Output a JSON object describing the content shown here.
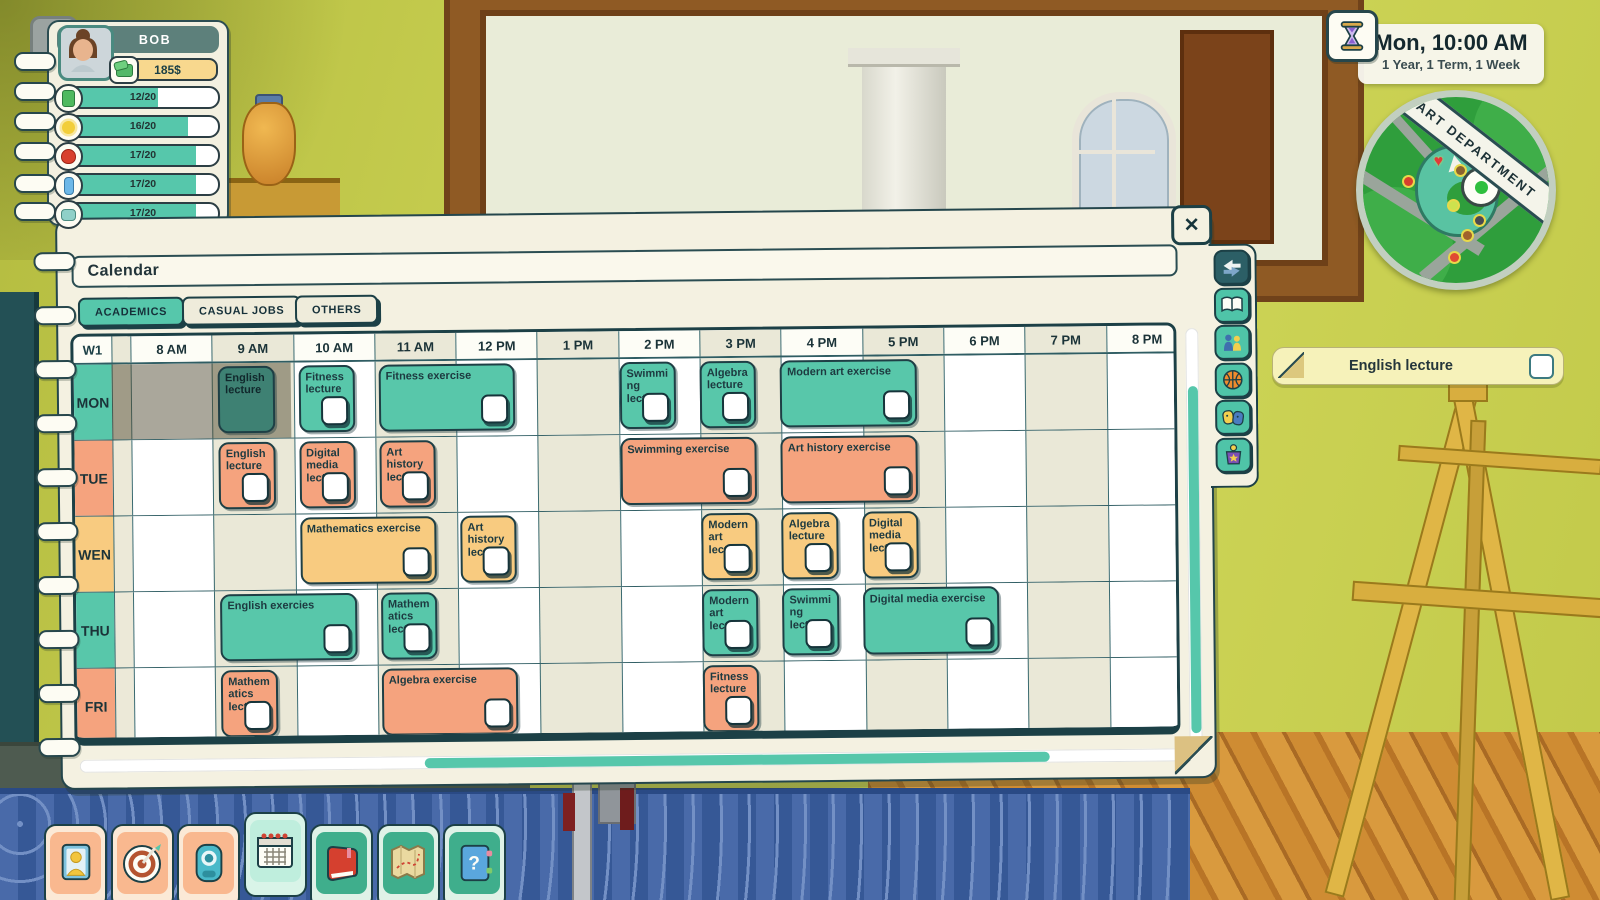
{
  "player": {
    "name": "BOB",
    "money": "185$",
    "stats": [
      {
        "icon": "battery-icon",
        "value": "12/20",
        "pct": 60
      },
      {
        "icon": "sun-icon",
        "value": "16/20",
        "pct": 80
      },
      {
        "icon": "apple-icon",
        "value": "17/20",
        "pct": 85
      },
      {
        "icon": "bottle-icon",
        "value": "17/20",
        "pct": 85
      },
      {
        "icon": "soap-icon",
        "value": "17/20",
        "pct": 85
      }
    ]
  },
  "help_button": {
    "label": "?"
  },
  "clock": {
    "time": "Mon, 10:00 AM",
    "progress": "1 Year, 1 Term, 1 Week",
    "icon": "hourglass-icon"
  },
  "minimap": {
    "banner": "ART DEPARTMENT",
    "markers": [
      {
        "name": "heart-marker",
        "x": 38,
        "y": 30,
        "glyph": "heart",
        "color": "#e03a3a"
      },
      {
        "name": "apple-marker",
        "x": 22,
        "y": 43,
        "glyph": "dot",
        "color": "#d8402e"
      },
      {
        "name": "satchel-marker",
        "x": 50,
        "y": 37,
        "glyph": "dot",
        "color": "#8a6230"
      },
      {
        "name": "friend-marker",
        "x": 63,
        "y": 29,
        "glyph": "dot",
        "color": "#e8c23a"
      },
      {
        "name": "pin-marker",
        "x": 46,
        "y": 56,
        "glyph": "dot",
        "color": "#cde24e"
      },
      {
        "name": "camera-marker",
        "x": 60,
        "y": 64,
        "glyph": "dot",
        "color": "#4a4a52"
      },
      {
        "name": "backpack-marker",
        "x": 54,
        "y": 72,
        "glyph": "dot",
        "color": "#a0622c"
      },
      {
        "name": "balloon-marker",
        "x": 47,
        "y": 84,
        "glyph": "dot",
        "color": "#e04a32"
      }
    ]
  },
  "notification": {
    "label": "English lecture"
  },
  "calendar": {
    "title": "Calendar",
    "tabs": [
      {
        "label": "ACADEMICS",
        "active": true
      },
      {
        "label": "CASUAL JOBS",
        "active": false
      },
      {
        "label": "OTHERS",
        "active": false
      }
    ],
    "week_label": "W1",
    "hours": [
      "8 AM",
      "9 AM",
      "10 AM",
      "11 AM",
      "12 PM",
      "1 PM",
      "2 PM",
      "3 PM",
      "4 PM",
      "5 PM",
      "6 PM",
      "7 PM",
      "8 PM"
    ],
    "days": [
      {
        "label": "MON",
        "color": "teal",
        "past_until_hour": 2,
        "events": [
          {
            "title": "English lecture",
            "start": 1,
            "span": 1,
            "past": true,
            "checkbox": false
          },
          {
            "title": "Fitness lecture",
            "start": 2,
            "span": 1,
            "checkbox": true
          },
          {
            "title": "Fitness exercise",
            "start": 3,
            "span": 2,
            "checkbox": true
          },
          {
            "title": "Swimming lecture",
            "start": 6,
            "span": 1,
            "checkbox": true
          },
          {
            "title": "Algebra lecture",
            "start": 7,
            "span": 1,
            "checkbox": true
          },
          {
            "title": "Modern art exercise",
            "start": 8,
            "span": 2,
            "checkbox": true
          }
        ]
      },
      {
        "label": "TUE",
        "color": "salmon",
        "events": [
          {
            "title": "English lecture",
            "start": 1,
            "span": 1,
            "checkbox": true
          },
          {
            "title": "Digital media lecture",
            "start": 2,
            "span": 1,
            "checkbox": true
          },
          {
            "title": "Art history lecture",
            "start": 3,
            "span": 1,
            "checkbox": true
          },
          {
            "title": "Swimming exercise",
            "start": 6,
            "span": 2,
            "checkbox": true
          },
          {
            "title": "Art history exercise",
            "start": 8,
            "span": 2,
            "checkbox": true
          }
        ]
      },
      {
        "label": "WEN",
        "color": "yellow",
        "events": [
          {
            "title": "Mathematics exercise",
            "start": 2,
            "span": 2,
            "checkbox": true
          },
          {
            "title": "Art history lecture",
            "start": 4,
            "span": 1,
            "checkbox": true
          },
          {
            "title": "Modern art lecture",
            "start": 7,
            "span": 1,
            "checkbox": true
          },
          {
            "title": "Algebra lecture",
            "start": 8,
            "span": 1,
            "checkbox": true
          },
          {
            "title": "Digital media lecture",
            "start": 9,
            "span": 1,
            "checkbox": true
          }
        ]
      },
      {
        "label": "THU",
        "color": "teal",
        "events": [
          {
            "title": "English exercies",
            "start": 1,
            "span": 2,
            "checkbox": true
          },
          {
            "title": "Mathematics lecture",
            "start": 3,
            "span": 1,
            "checkbox": true
          },
          {
            "title": "Modern art lecture",
            "start": 7,
            "span": 1,
            "checkbox": true
          },
          {
            "title": "Swimming lecture",
            "start": 8,
            "span": 1,
            "checkbox": true
          },
          {
            "title": "Digital media exercise",
            "start": 9,
            "span": 2,
            "checkbox": true
          }
        ]
      },
      {
        "label": "FRI",
        "color": "salmon",
        "events": [
          {
            "title": "Mathematics lecture",
            "start": 1,
            "span": 1,
            "checkbox": true
          },
          {
            "title": "Algebra exercise",
            "start": 3,
            "span": 2,
            "checkbox": true
          },
          {
            "title": "Fitness lecture",
            "start": 7,
            "span": 1,
            "checkbox": true
          }
        ]
      }
    ],
    "sidebar_icons": [
      "swap-arrows-icon",
      "book-icon",
      "social-icon",
      "basketball-icon",
      "masks-icon",
      "trophy-icon"
    ]
  },
  "toolbar": {
    "buttons": [
      {
        "name": "character",
        "icon": "portrait-icon",
        "active": false
      },
      {
        "name": "objectives",
        "icon": "target-icon",
        "active": false
      },
      {
        "name": "phone",
        "icon": "phone-icon",
        "active": false
      },
      {
        "name": "calendar",
        "icon": "calendar-icon",
        "active": true
      },
      {
        "name": "journal",
        "icon": "red-book-icon",
        "active": false
      },
      {
        "name": "map",
        "icon": "map-icon",
        "active": false
      },
      {
        "name": "help",
        "icon": "help-book-icon",
        "active": false
      }
    ]
  },
  "colors": {
    "teal": "#58c7aa",
    "salmon": "#f5a37e",
    "yellow": "#f8cb80",
    "past_teal": "#3e8173",
    "ink": "#1c4046",
    "tab_active": "#56c7ab",
    "day_teal": "#58c7aa",
    "day_salmon": "#f5a37e",
    "day_yellow": "#f8cb80"
  }
}
